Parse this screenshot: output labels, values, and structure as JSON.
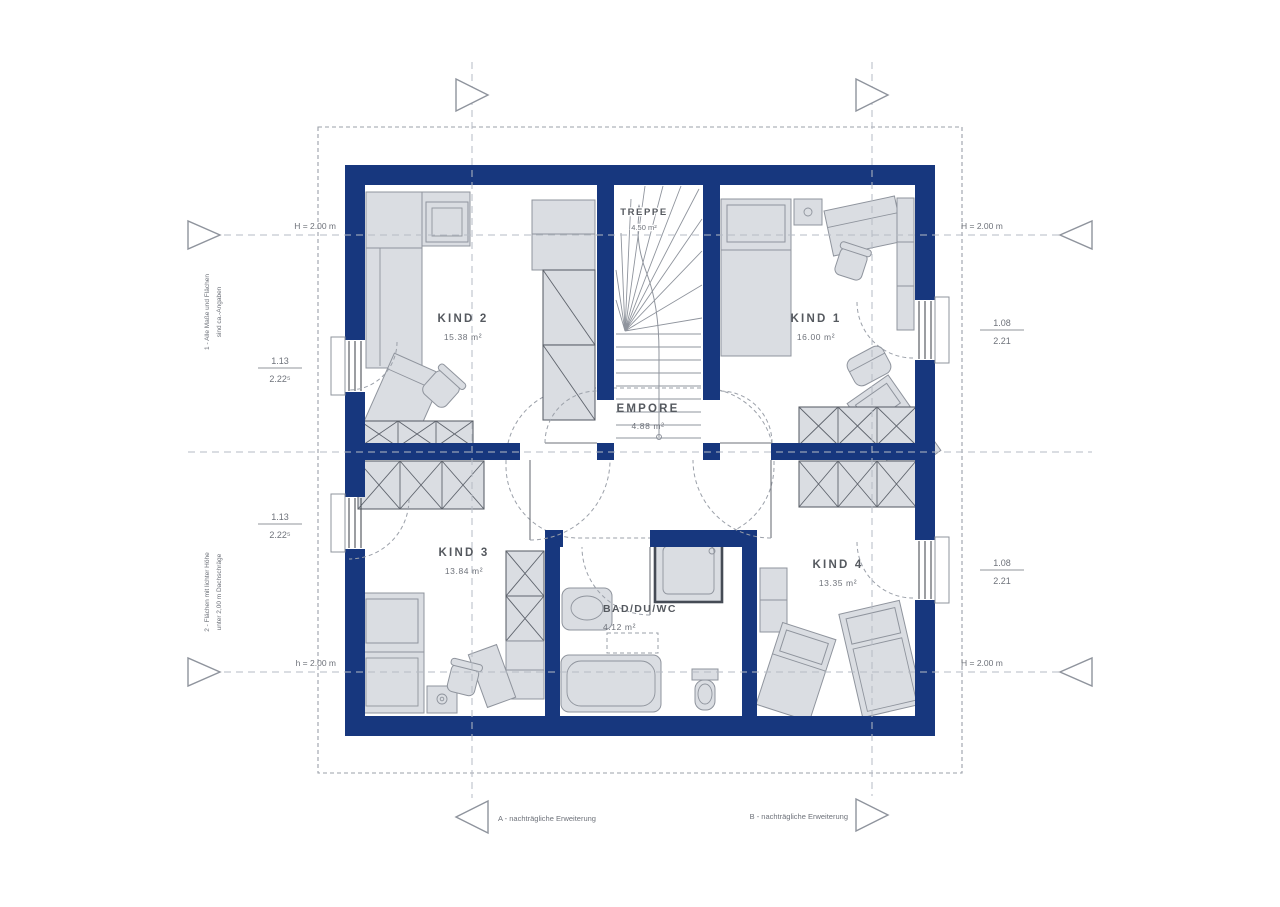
{
  "rooms": {
    "kind1": {
      "name": "KIND 1",
      "area": "16.00 m²"
    },
    "kind2": {
      "name": "KIND 2",
      "area": "15.38 m²"
    },
    "kind3": {
      "name": "KIND 3",
      "area": "13.84 m²"
    },
    "kind4": {
      "name": "KIND 4",
      "area": "13.35 m²"
    },
    "empore": {
      "name": "EMPORE",
      "area": "4.88 m²"
    },
    "bad": {
      "name": "BAD/DU/WC",
      "area": "4.12 m²"
    },
    "treppe": {
      "name": "TREPPE",
      "area": "4.50 m²"
    }
  },
  "dimensions": {
    "left_upper": {
      "width": "1.13",
      "sill": "2.22⁵"
    },
    "left_lower": {
      "width": "1.13",
      "sill": "2.22⁵"
    },
    "right_upper": {
      "width": "1.08",
      "sill": "2.21"
    },
    "right_lower": {
      "width": "1.08",
      "sill": "2.21"
    }
  },
  "height_lines": {
    "top_left": "H = 2.00 m",
    "top_right": "H = 2.00 m",
    "bottom_left": "h = 2.00 m",
    "bottom_right": "H = 2.00 m"
  },
  "annotations": {
    "extension_a": "A - nachträgliche Erweiterung",
    "extension_b": "B - nachträgliche Erweiterung",
    "note_upper_1": "1 - Alle Maße und Flächen",
    "note_upper_2": "sind ca.-Angaben",
    "note_lower_1": "2 - Flächen mit lichter Höhe",
    "note_lower_2": "unter 2,00 m Dachschräge"
  },
  "colors": {
    "wall": "#17377E",
    "furn": "#DADDE2",
    "fstroke": "#8F949D",
    "hatch": "#5F646D",
    "dash": "#9BA0A9",
    "text": "#55595F",
    "text2": "#6E727A",
    "win": "#4A4F57",
    "guide": "#B6BBC4"
  }
}
